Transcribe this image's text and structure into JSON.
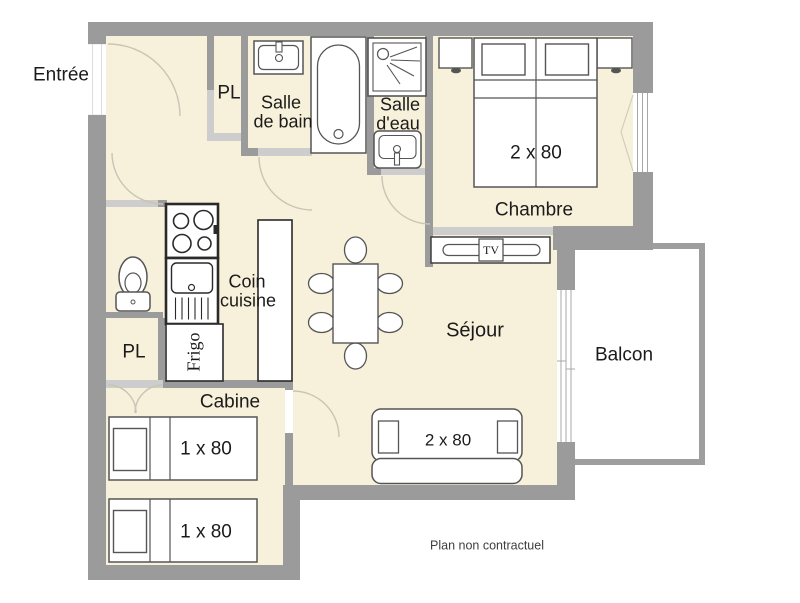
{
  "note": "Plan non contractuel",
  "rooms": {
    "entree": {
      "label": "Entrée"
    },
    "pl_haut": {
      "label": "PL"
    },
    "salle_de_bain": {
      "line1": "Salle",
      "line2": "de bain"
    },
    "salle_deau": {
      "line1": "Salle",
      "line2": "d'eau"
    },
    "chambre": {
      "label": "Chambre",
      "bed_size": "2 x 80"
    },
    "coin_cuisine": {
      "line1": "Coin",
      "line2": "cuisine"
    },
    "sejour": {
      "label": "Séjour",
      "sofa_size": "2 x 80"
    },
    "balcon": {
      "label": "Balcon"
    },
    "pl_bas": {
      "label": "PL"
    },
    "cabine": {
      "label": "Cabine",
      "bed1_size": "1 x 80",
      "bed2_size": "1 x 80"
    }
  },
  "appliances": {
    "fridge": "Frigo",
    "tv": "TV"
  },
  "colors": {
    "wall": "#9b9b9b",
    "door_opening": "#cdcdcd",
    "floor": "#f7f0da",
    "balcony_wall": "#9e9e9e",
    "furniture_outline": "#555555",
    "text": "#1b1b1b"
  }
}
